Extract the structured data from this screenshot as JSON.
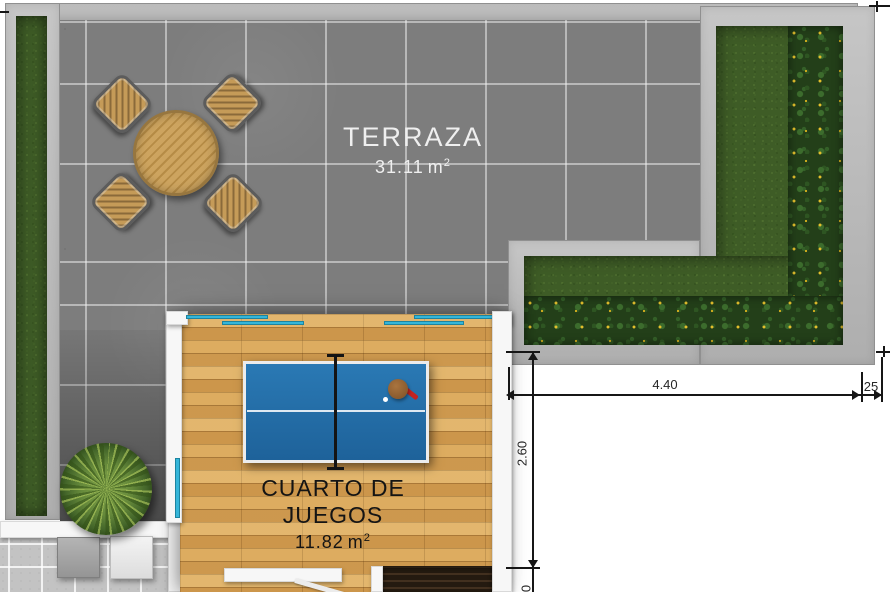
{
  "plan": {
    "rooms": [
      {
        "id": "terraza",
        "name": "TERRAZA",
        "area_value": "31.11",
        "area_unit": "m",
        "area_sup": "2"
      },
      {
        "id": "cuarto-de-juegos",
        "name": "CUARTO DE JUEGOS",
        "area_value": "11.82",
        "area_unit": "m",
        "area_sup": "2"
      }
    ],
    "dimensions": {
      "horizontal_main": "4.40",
      "horizontal_small": "25",
      "vertical_room": "2.60",
      "vertical_partial": "0"
    },
    "objects": [
      "round-dining-table",
      "outdoor-chair",
      "ping-pong-table",
      "paddle",
      "fern-plant",
      "grass-lawn",
      "flower-border",
      "planter-box",
      "stairs",
      "sliding-glass-door"
    ],
    "colors": {
      "tile_gray": "#7d7d7d",
      "curb_gray": "#b8b8b8",
      "grass_green": "#3e5c26",
      "wood_floor": "#d8a456",
      "table_blue": "#2471ab",
      "glass_cyan": "#35b6d9",
      "label_white": "#efefef",
      "label_black": "#161616"
    }
  }
}
